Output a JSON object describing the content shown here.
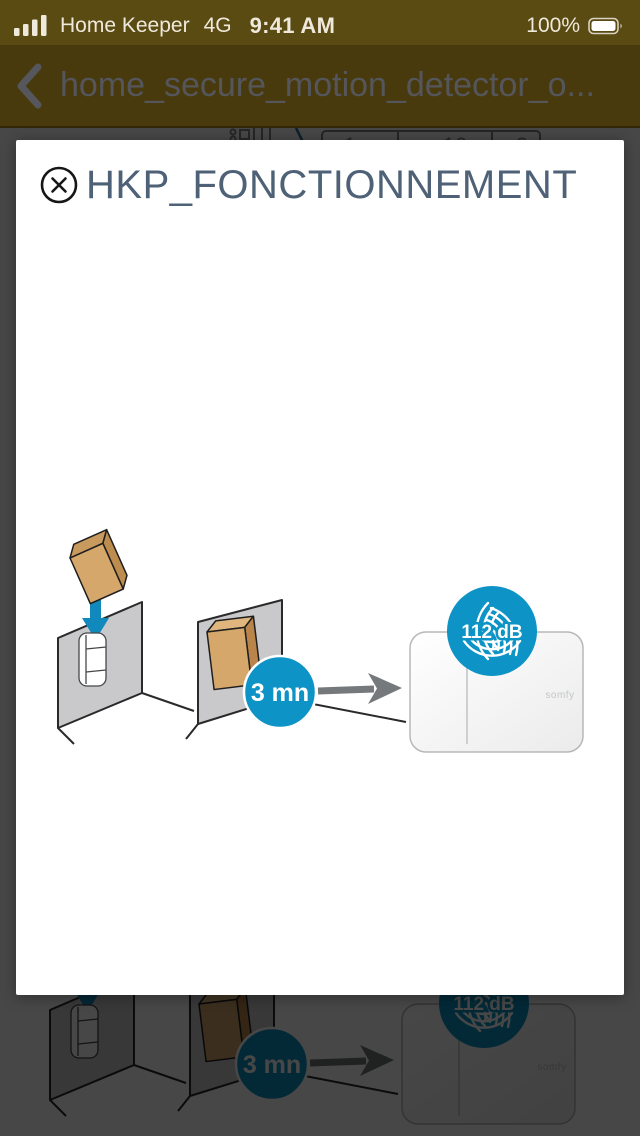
{
  "status_bar": {
    "carrier": "Home Keeper",
    "network": "4G",
    "time": "9:41 AM",
    "battery_percent": "100%"
  },
  "nav_bar": {
    "title": "home_secure_motion_detector_o..."
  },
  "modal": {
    "title": "HKP_FONCTIONNEMENT"
  },
  "illustration": {
    "delay_label": "3 mn",
    "volume_label": "112 dB",
    "brand_label": "somfy"
  },
  "underlay_strip": {
    "partial_digits": [
      "1",
      "12",
      "3"
    ]
  },
  "colors": {
    "accent_blue": "#0D93C5",
    "dimmed_yellow_status": "#5A4B13",
    "dimmed_yellow_nav": "#483A0D",
    "modal_title_slate": "#4E6176",
    "wall_gray": "#C9C9CB",
    "carton_tan": "#D5A76B",
    "arrow_gray": "#75797C"
  }
}
